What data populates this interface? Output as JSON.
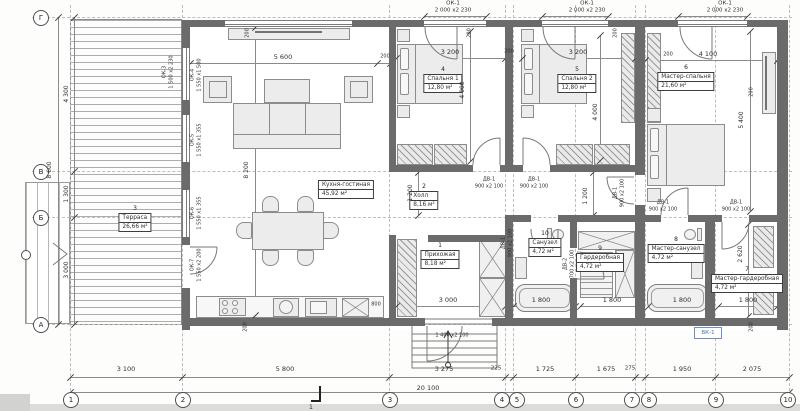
{
  "plan": {
    "rooms": [
      {
        "num": "1",
        "name": "Прихожая",
        "area": "8,18 м²"
      },
      {
        "num": "2",
        "name": "Холл",
        "area": "8,16 м²"
      },
      {
        "num": "3",
        "name": "Терраса",
        "area": "26,66 м²"
      },
      {
        "num": "4",
        "name": "Спальня 1",
        "area": "12,80 м²"
      },
      {
        "num": "5",
        "name": "Спальня 2",
        "area": "12,80 м²"
      },
      {
        "num": "6",
        "name": "Мастер-спальня",
        "area": "21,60 м²"
      },
      {
        "num": "7",
        "name": "Мастер-гардеробная",
        "area": "4,72 м²"
      },
      {
        "num": "8",
        "name": "Мастер-санузел",
        "area": "4,72 м²"
      },
      {
        "num": "9",
        "name": "Гардеробная",
        "area": "4,72 м²"
      },
      {
        "num": "10",
        "name": "Санузел",
        "area": "4,72 м²"
      },
      {
        "num": "",
        "name": "Кухня-гостиная",
        "area": "45,92 м²"
      }
    ],
    "grid_cols": [
      "1",
      "2",
      "3",
      "4",
      "5",
      "6",
      "7",
      "8",
      "9",
      "10"
    ],
    "grid_rows": [
      "Г",
      "В",
      "Б",
      "А"
    ],
    "dims": {
      "bottom": [
        "3 100",
        "5 800",
        "3 275",
        "225",
        "1 725",
        "1 675",
        "275",
        "1 950",
        "2 075"
      ],
      "bottom_total": "20 100",
      "left": [
        "4 300",
        "1 300",
        "3 000"
      ],
      "left_total": "8 600",
      "living_w": "5 600",
      "living_h": "8 200",
      "bedroom_w": "3 200",
      "bedroom_h": "4 000",
      "master_w": "4 100",
      "master_h": "5 400",
      "hall_w": "1 200",
      "entry_w": "3 000",
      "tub_l": "1 800",
      "mg_h": "2 620",
      "wall": "200",
      "offset": "800"
    },
    "openings": {
      "ok1": {
        "code": "ОК-1",
        "size": "2 000 х2 230"
      },
      "ok3": {
        "code": "ОК-3",
        "size": "1 500 х2 230"
      },
      "ok4": {
        "code": "ОК-4",
        "size": "1 550 х1 500"
      },
      "ok5": {
        "code": "ОК-5",
        "size": "1 550 х1 355"
      },
      "ok6": {
        "code": "ОК-6",
        "size": "1 550 х1 355"
      },
      "ok7": {
        "code": "ОК-7",
        "size": "1 550 х2 200"
      },
      "dv1": {
        "code": "ДВ-1",
        "size": "900 х2 100"
      },
      "dv2": {
        "code": "ДВ-2",
        "size": "700 х2 100"
      },
      "entry_door": {
        "size": "1 400 х2 100"
      }
    },
    "marks": {
      "section": "1",
      "riser": "ВК-1"
    }
  }
}
